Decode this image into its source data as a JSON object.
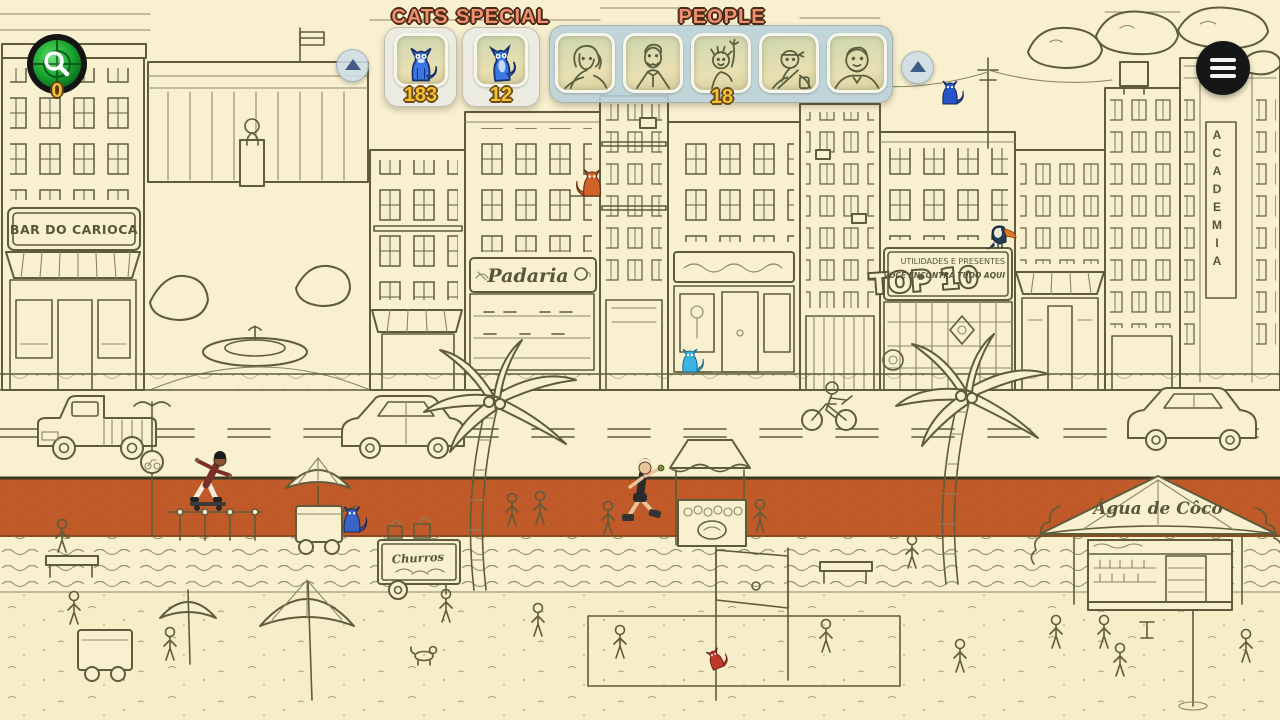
{
  "app": {
    "name": "hidden-cats-beach-city-scene"
  },
  "hud": {
    "magnifier_button": {
      "count": "0",
      "icon": "magnifier-radar-icon"
    },
    "menu_button": {
      "icon": "hamburger-menu-icon"
    },
    "scroll_buttons": {
      "icon": "up-arrow-icon"
    },
    "cats_panel": {
      "title": "CATS",
      "count": "183",
      "tile_icon": "blue-cat-icon"
    },
    "special_panel": {
      "title": "SPECIAL",
      "count": "12",
      "tile_icon": "blue-special-cat-icon"
    },
    "people_panel": {
      "title": "PEOPLE",
      "count": "18",
      "portraits": [
        "curly-haired-man",
        "mustached-man-in-suit",
        "waving-spiky-haired-person",
        "person-with-headband-and-bag",
        "smiling-heavyset-man"
      ]
    },
    "colors": {
      "panel_title": "#ef8f6d",
      "count_text": "#f6c231",
      "panel_bg": "#e9eae2",
      "people_panel_bg": "#b7d0d9"
    }
  },
  "scene": {
    "signs": {
      "bar": "BAR DO CARIOCA",
      "bakery": "Padaria",
      "top10": "TOP 10",
      "gift_shop_line1": "UTILIDADES E PRESENTES",
      "gift_shop_line2": "VOCÊ ENCONTRA TUDO AQUI",
      "coconut_kiosk": "Água de Côco",
      "churros_cart": "Churros",
      "academia": "ACADEMIA"
    },
    "hidden_objects": [
      {
        "name": "blue-cat-near-right-arrow",
        "color": "#2456c8",
        "x": 950,
        "y": 92
      },
      {
        "name": "orange-cat-on-ledge",
        "color": "#d06428",
        "x": 590,
        "y": 182
      },
      {
        "name": "toucan-on-sign",
        "color": "#223a55",
        "x": 1000,
        "y": 238
      },
      {
        "name": "cyan-cat-by-shop-door",
        "color": "#3ab4e4",
        "x": 688,
        "y": 360
      },
      {
        "name": "blue-cat-on-sidewalk",
        "color": "#3b63c8",
        "x": 350,
        "y": 525
      },
      {
        "name": "red-cat-on-net-pole",
        "color": "#c03828",
        "x": 716,
        "y": 662
      }
    ],
    "characters": [
      {
        "name": "skater-on-rail",
        "x": 206,
        "y": 478
      },
      {
        "name": "rollerblader",
        "x": 643,
        "y": 460
      }
    ],
    "colors": {
      "background": "#f8f0cf",
      "linework": "#5e5c3c",
      "promenade_wall": "#c05a28"
    }
  }
}
